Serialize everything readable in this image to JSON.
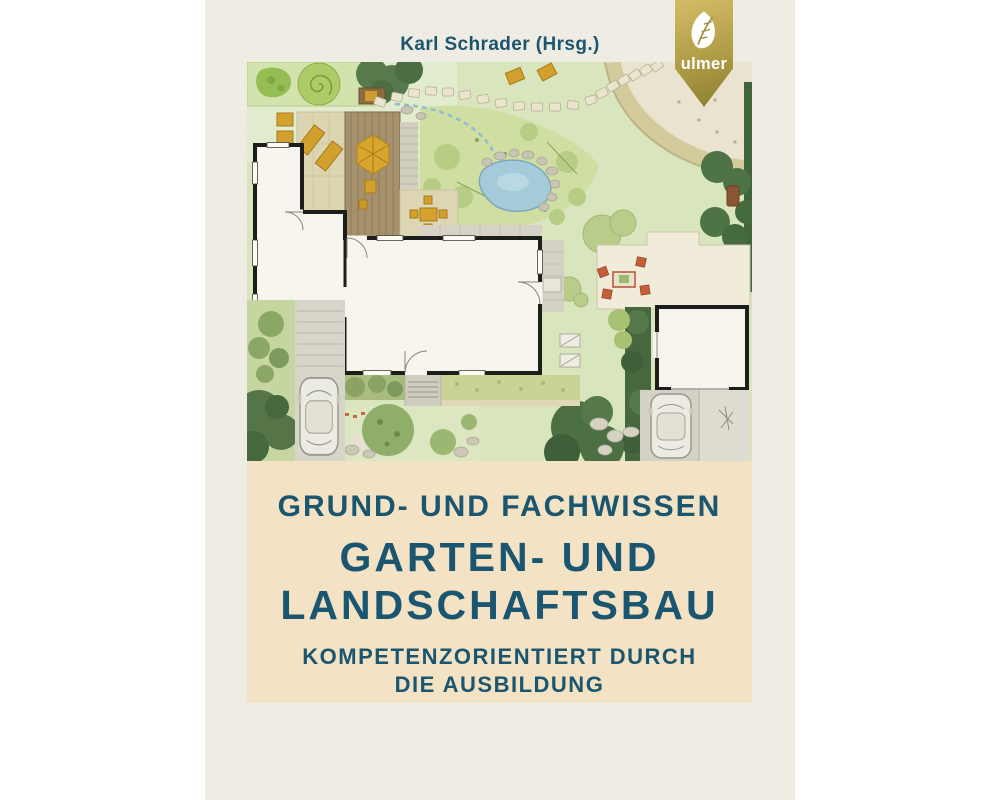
{
  "page": {
    "background_color": "#ffffff"
  },
  "cover": {
    "author_line": "Karl Schrader (Hrsg.)",
    "publisher_badge": {
      "name": "ulmer",
      "icon": "leaf-icon",
      "gold_light": "#d4bc66",
      "gold_dark": "#8c7e31"
    },
    "title_block": {
      "kicker": "GRUND- UND FACHWISSEN",
      "title_line1": "GARTEN- UND",
      "title_line2": "LANDSCHAFTSBAU",
      "subtitle_line1": "KOMPETENZORIENTIERT DURCH",
      "subtitle_line2": "DIE AUSBILDUNG"
    },
    "colors": {
      "cover_background": "#efece3",
      "title_band_background": "#f3e2c3",
      "title_text": "#1a566f"
    }
  }
}
